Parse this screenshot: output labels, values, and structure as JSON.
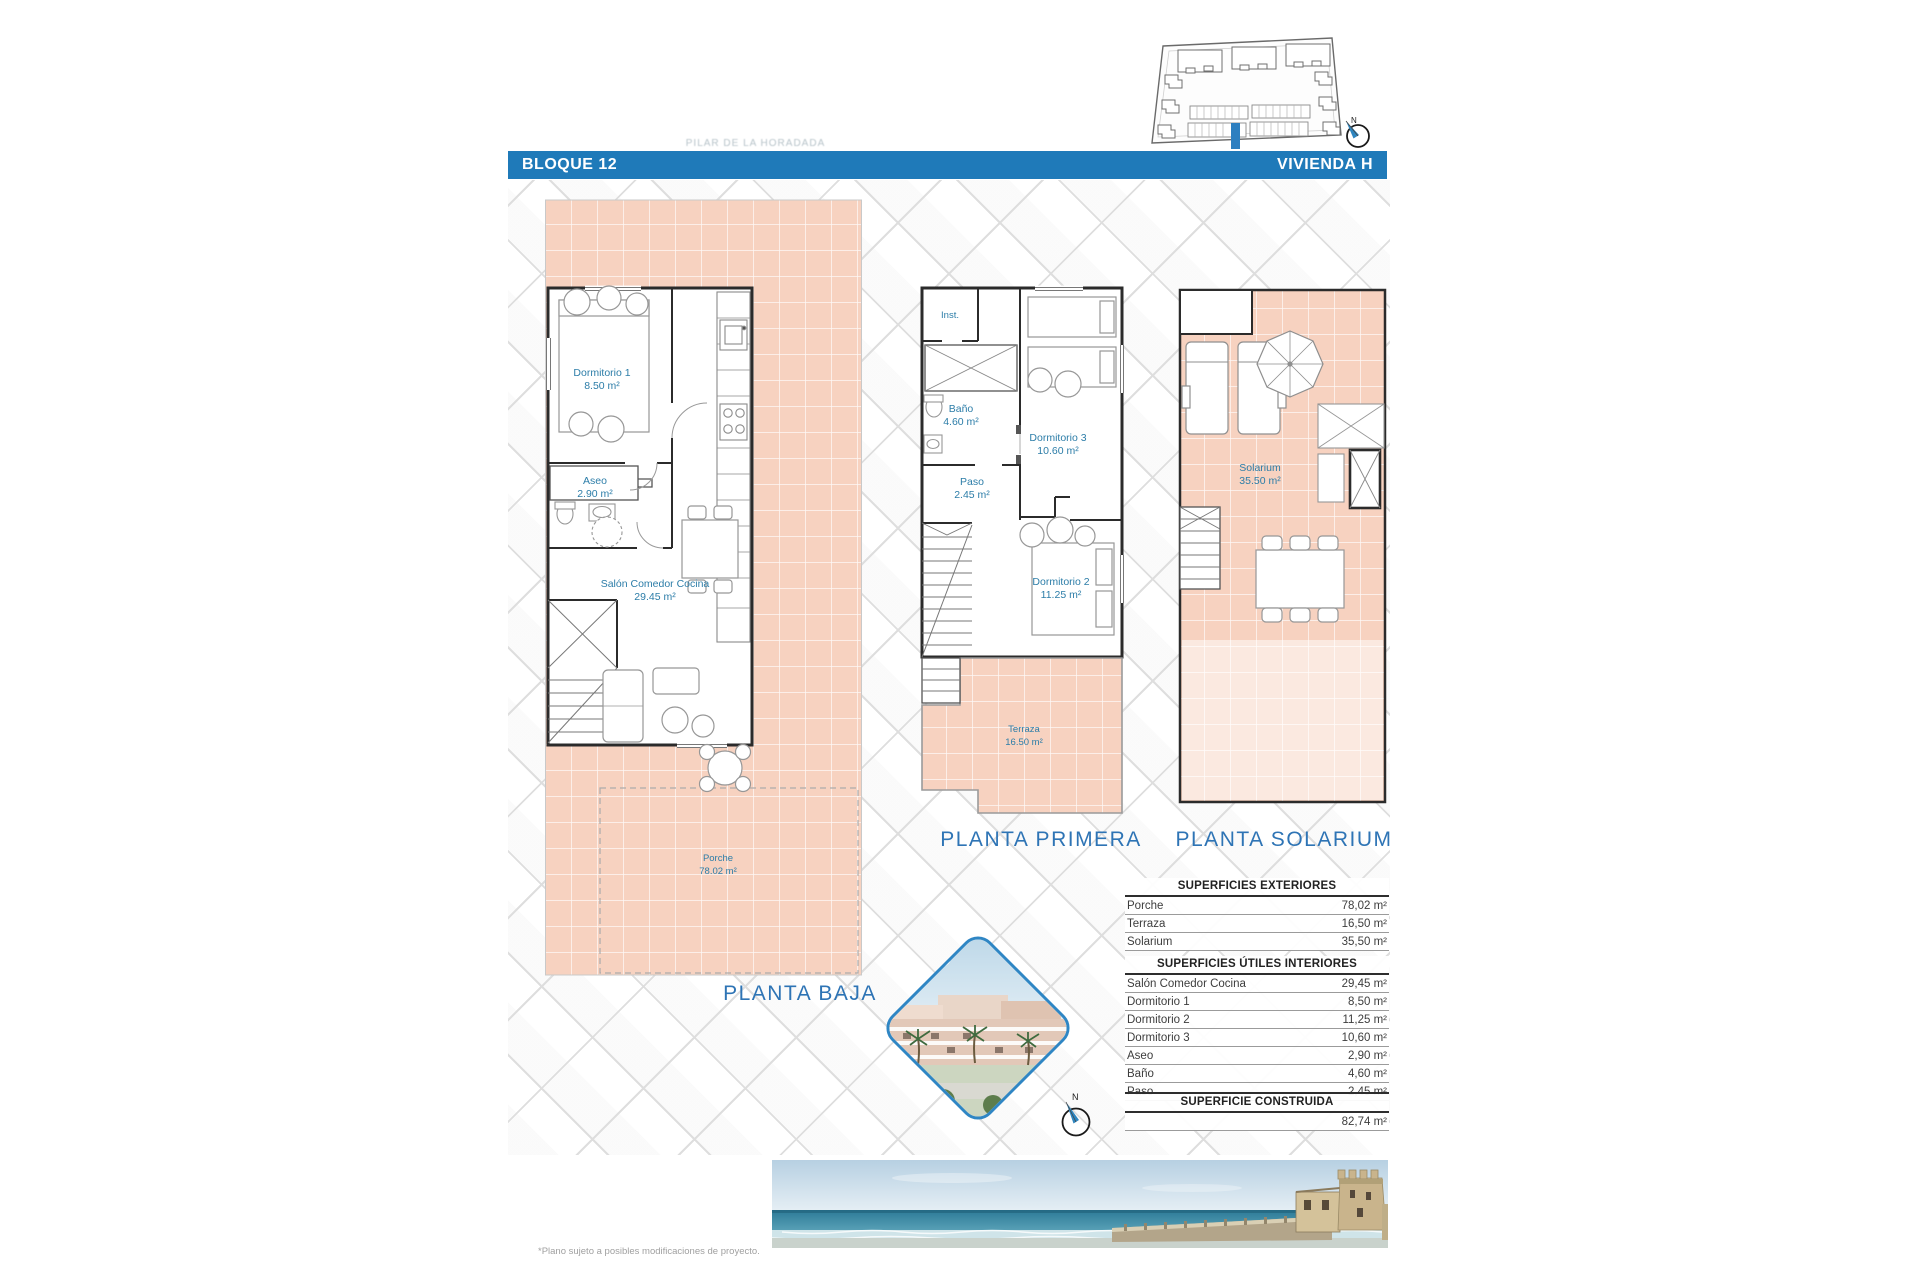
{
  "header": {
    "left": "BLOQUE 12",
    "right": "VIVIENDA H"
  },
  "watermark": "PILAR DE LA HORADADA",
  "compass_n": "N",
  "plans": {
    "baja": {
      "title": "PLANTA BAJA",
      "rooms": {
        "dormitorio1": {
          "name": "Dormitorio 1",
          "area": "8.50 m²"
        },
        "aseo": {
          "name": "Aseo",
          "area": "2.90 m²"
        },
        "salon": {
          "name": "Salón Comedor Cocina",
          "area": "29.45 m²"
        },
        "porche": {
          "name": "Porche",
          "area": "78.02 m²"
        }
      }
    },
    "primera": {
      "title": "PLANTA PRIMERA",
      "rooms": {
        "inst": {
          "name": "Inst."
        },
        "bano": {
          "name": "Baño",
          "area": "4.60 m²"
        },
        "dormitorio3": {
          "name": "Dormitorio 3",
          "area": "10.60 m²"
        },
        "paso": {
          "name": "Paso",
          "area": "2.45 m²"
        },
        "dormitorio2": {
          "name": "Dormitorio 2",
          "area": "11.25 m²"
        },
        "terraza": {
          "name": "Terraza",
          "area": "16.50 m²"
        }
      }
    },
    "solarium": {
      "title": "PLANTA SOLARIUM",
      "rooms": {
        "solarium": {
          "name": "Solarium",
          "area": "35.50 m²"
        }
      }
    }
  },
  "tables": {
    "exteriores": {
      "title": "SUPERFICIES EXTERIORES",
      "rows": [
        {
          "label": "Porche",
          "value": "78,02 m²"
        },
        {
          "label": "Terraza",
          "value": "16,50 m²"
        },
        {
          "label": "Solarium",
          "value": "35,50 m²"
        }
      ]
    },
    "interiores": {
      "title": "SUPERFICIES ÚTILES INTERIORES",
      "rows": [
        {
          "label": "Salón Comedor Cocina",
          "value": "29,45 m²"
        },
        {
          "label": "Dormitorio 1",
          "value": "8,50 m²"
        },
        {
          "label": "Dormitorio 2",
          "value": "11,25 m²"
        },
        {
          "label": "Dormitorio 3",
          "value": "10,60 m²"
        },
        {
          "label": "Aseo",
          "value": "2,90 m²"
        },
        {
          "label": "Baño",
          "value": "4,60 m²"
        },
        {
          "label": "Paso",
          "value": "2,45 m²"
        }
      ]
    },
    "construida": {
      "title": "SUPERFICIE CONSTRUIDA",
      "value": "82,74 m²"
    }
  },
  "footnote": "*Plano sujeto a posibles modificaciones de proyecto.",
  "colors": {
    "accent_blue": "#1f7ab9",
    "salmon_tile": "#f7d2c0",
    "room_label_blue": "#2c7da8",
    "title_blue": "#2e74b5",
    "highlight_unit_blue": "#2d7fc0"
  }
}
